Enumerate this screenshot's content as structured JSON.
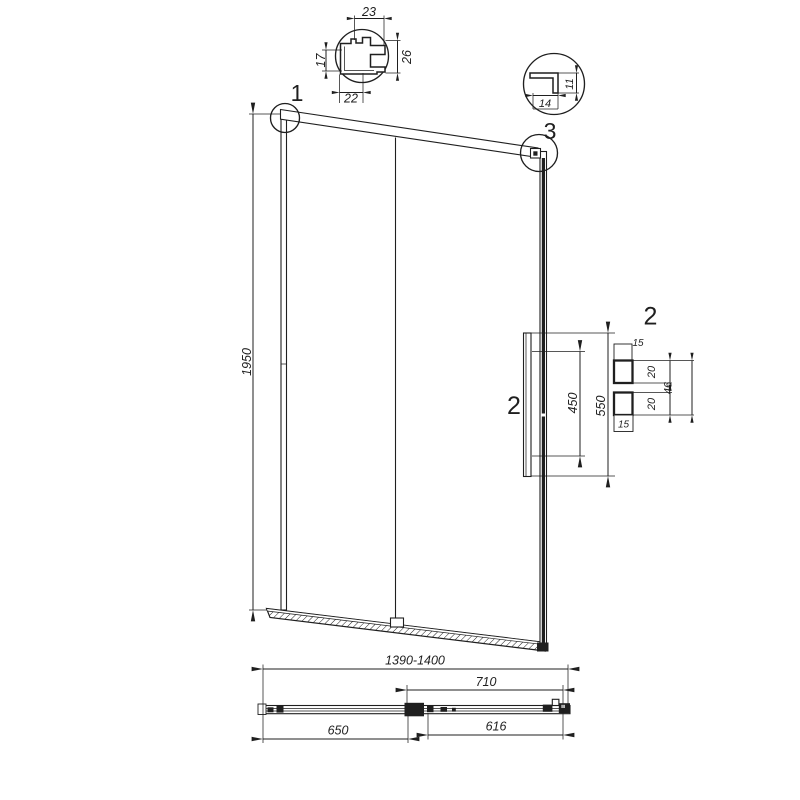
{
  "meta": {
    "description": "Technical line drawing of a sliding shower door with detail callouts"
  },
  "callouts": {
    "one": "1",
    "two": "2",
    "three": "3"
  },
  "dims": {
    "height": "1950",
    "width_range": "1390-1400",
    "door_width": "710",
    "fixed_panel": "650",
    "glass_width": "616",
    "handle_inner": "450",
    "handle_outer": "550"
  },
  "profile_top": {
    "width": "23",
    "left": "17",
    "right": "26",
    "bottom": "22"
  },
  "profile_corner": {
    "depth": "11",
    "width": "14"
  },
  "handle_section": {
    "offset_top": "15",
    "post_top": "20",
    "span": "46",
    "post_bottom": "20",
    "offset_bottom": "15"
  },
  "colors": {
    "line": "#1f1f1f",
    "background": "#ffffff"
  }
}
